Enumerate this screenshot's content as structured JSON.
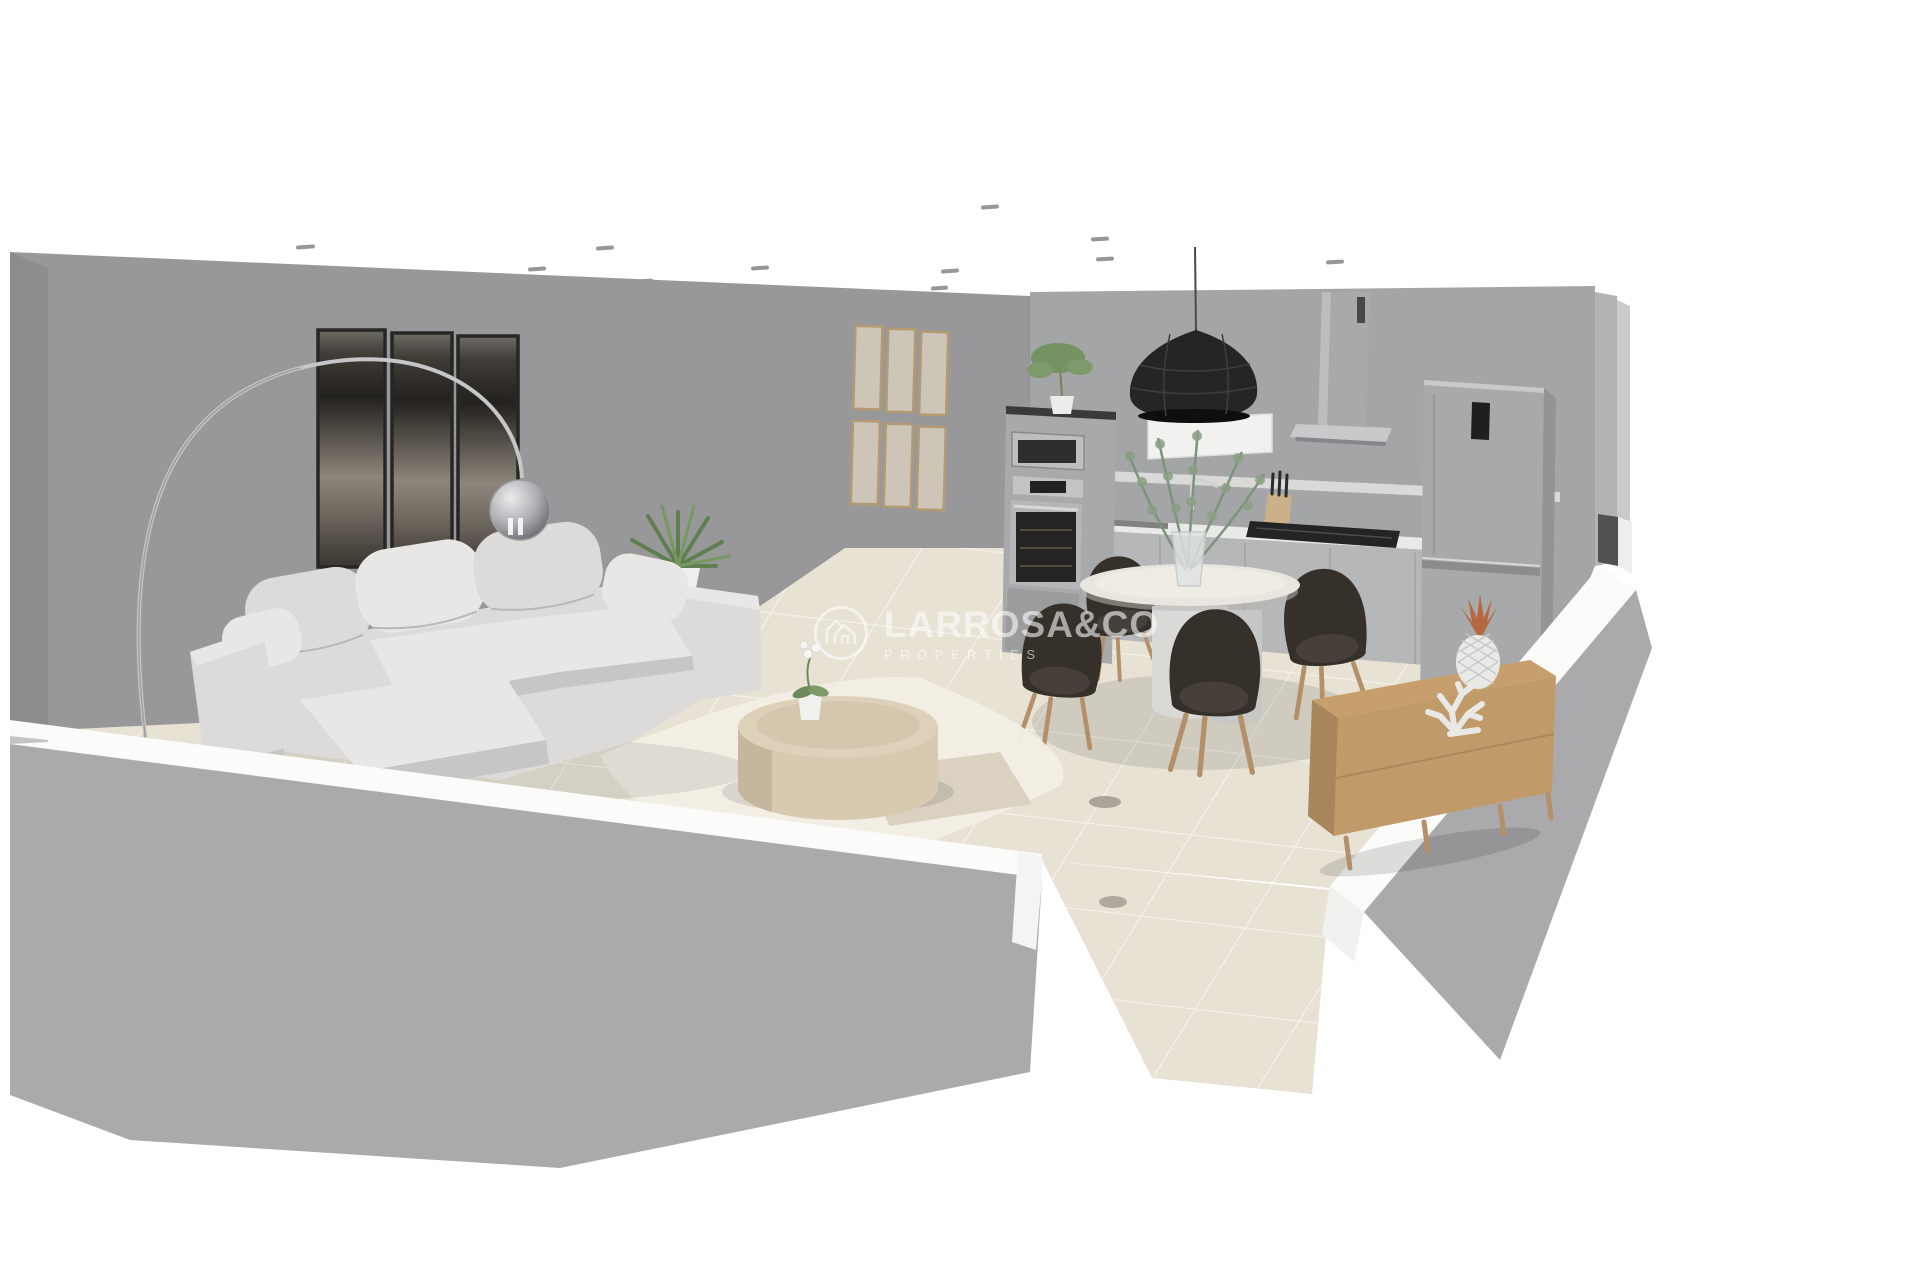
{
  "meta": {
    "scene_type": "3d-interior-cutaway-render",
    "view": "dollhouse-perspective",
    "rooms": [
      "living-room",
      "kitchen-dining"
    ]
  },
  "watermark": {
    "brand": "LARROSA&CO",
    "subtitle": "PROPERTIES",
    "logo_icon": "house-logo-icon"
  },
  "palette": {
    "background": "#ffffff",
    "wall": "#98989a",
    "wall-kitchen": "#a4a5a7",
    "wall-edge": "#8d8d8f",
    "wall-cut": "#fbfbfa",
    "wall-outer": "#aaaaac",
    "floor": "#e8e2d5",
    "sofa": "#dcdbd9",
    "sofa-light": "#e8e7e5",
    "sofa-dark": "#c7c6c4",
    "counter": "#b6b7b9",
    "steel": "#a8a9ab",
    "chair": "#35302a",
    "chair-leg": "#b3906a",
    "wood-sideboard": "#c79f6d",
    "wood-table": "#d7cab1",
    "art": "#2f2c28",
    "pendant": "#1d1d1f",
    "plant": "#6f915c",
    "copper": "#b5683f",
    "watermark": "#ffffff"
  },
  "scene": {
    "items": [
      {
        "name": "ceiling-spotlights",
        "count": 13
      },
      {
        "name": "triptych-wall-art",
        "panels": 3
      },
      {
        "name": "wall-frame-grid",
        "frames": 6
      },
      {
        "name": "arc-floor-lamp"
      },
      {
        "name": "corner-sofa",
        "cushions": 6
      },
      {
        "name": "yucca-plant"
      },
      {
        "name": "area-rug"
      },
      {
        "name": "round-coffee-table"
      },
      {
        "name": "orchid-pot"
      },
      {
        "name": "pendant-lamp"
      },
      {
        "name": "oven-tower",
        "appliances": [
          "microwave",
          "oven"
        ]
      },
      {
        "name": "kitchen-counter",
        "features": [
          "sink",
          "faucet",
          "knife-block",
          "hob"
        ]
      },
      {
        "name": "cooker-hood"
      },
      {
        "name": "fridge-freezer"
      },
      {
        "name": "dining-table"
      },
      {
        "name": "dining-chairs",
        "count": 4
      },
      {
        "name": "eucalyptus-vase"
      },
      {
        "name": "wood-sideboard"
      },
      {
        "name": "pineapple-ornament"
      },
      {
        "name": "coral-ornament"
      },
      {
        "name": "tiled-floor"
      },
      {
        "name": "cutaway-walls"
      }
    ]
  }
}
